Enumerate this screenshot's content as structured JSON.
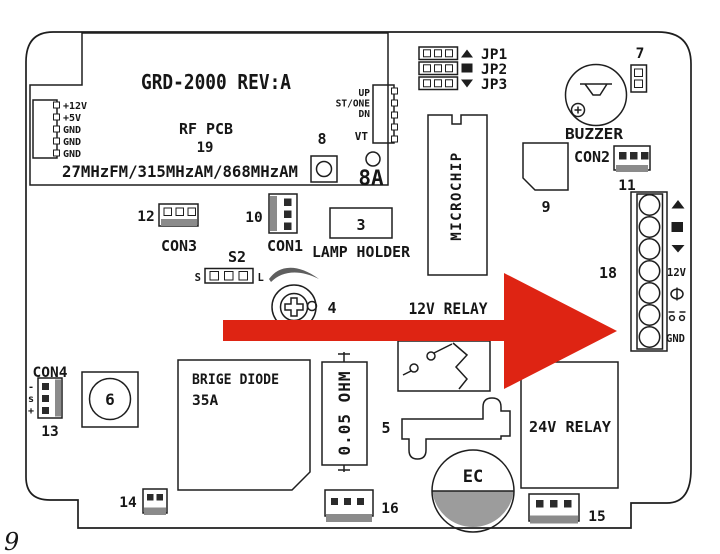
{
  "page": {
    "number": "9"
  },
  "colors": {
    "arrow_red": "#de2413",
    "line_black": "#1e1e1e",
    "fill_gray": "#8b8b8b",
    "background": "#ffffff"
  },
  "rf_module": {
    "title": "GRD-2000 REV:A",
    "name": "RF PCB",
    "ref": "19",
    "frequencies": "27MHzFM/315MHzAM/868MHzAM",
    "power_pins": [
      "+12V",
      "+5V",
      "GND",
      "GND",
      "GND"
    ],
    "buttons": {
      "up": "UP",
      "st_one": "ST/ONE",
      "dn": "DN",
      "vt": "VT"
    },
    "ref8": "8",
    "ref8a": "8A"
  },
  "jumpers": [
    {
      "label": "JP1",
      "symbol": "up-triangle"
    },
    {
      "label": "JP2",
      "symbol": "filled-square"
    },
    {
      "label": "JP3",
      "symbol": "down-triangle"
    }
  ],
  "buzzer": {
    "label": "BUZZER",
    "ref7": "7"
  },
  "con2": {
    "label": "CON2",
    "ref": "11"
  },
  "chip9": {
    "ref": "9"
  },
  "microchip": {
    "label": "MICROCHIP"
  },
  "relay12": {
    "label": "12V RELAY"
  },
  "terminal_block": {
    "ref": "18",
    "symbols": [
      "up-triangle",
      "filled-square",
      "down-triangle",
      "12V",
      "lamp",
      "contact",
      "GND"
    ],
    "label_12v": "12V",
    "label_gnd": "GND"
  },
  "con3": {
    "ref": "12",
    "label": "CON3"
  },
  "con1": {
    "ref": "10",
    "label": "CON1"
  },
  "lamp_holder": {
    "ref": "3",
    "label": "LAMP HOLDER"
  },
  "s2": {
    "label": "S2",
    "s": "S",
    "l": "L"
  },
  "pot": {
    "ref": "4"
  },
  "con4": {
    "label": "CON4",
    "ref": "13",
    "pins": [
      "-",
      "s",
      "+"
    ]
  },
  "comp6": {
    "ref": "6"
  },
  "bridge_diode": {
    "name": "BRIGE DIODE",
    "rating": "35A"
  },
  "resistor": {
    "label": "0.05 OHM"
  },
  "fuse": {
    "ref": "5"
  },
  "ec_cap": {
    "label": "EC"
  },
  "relay24": {
    "label": "24V RELAY"
  },
  "con14": {
    "ref": "14"
  },
  "con15": {
    "ref": "15"
  },
  "con16": {
    "ref": "16"
  },
  "arrow": {
    "color": "#de2413"
  }
}
